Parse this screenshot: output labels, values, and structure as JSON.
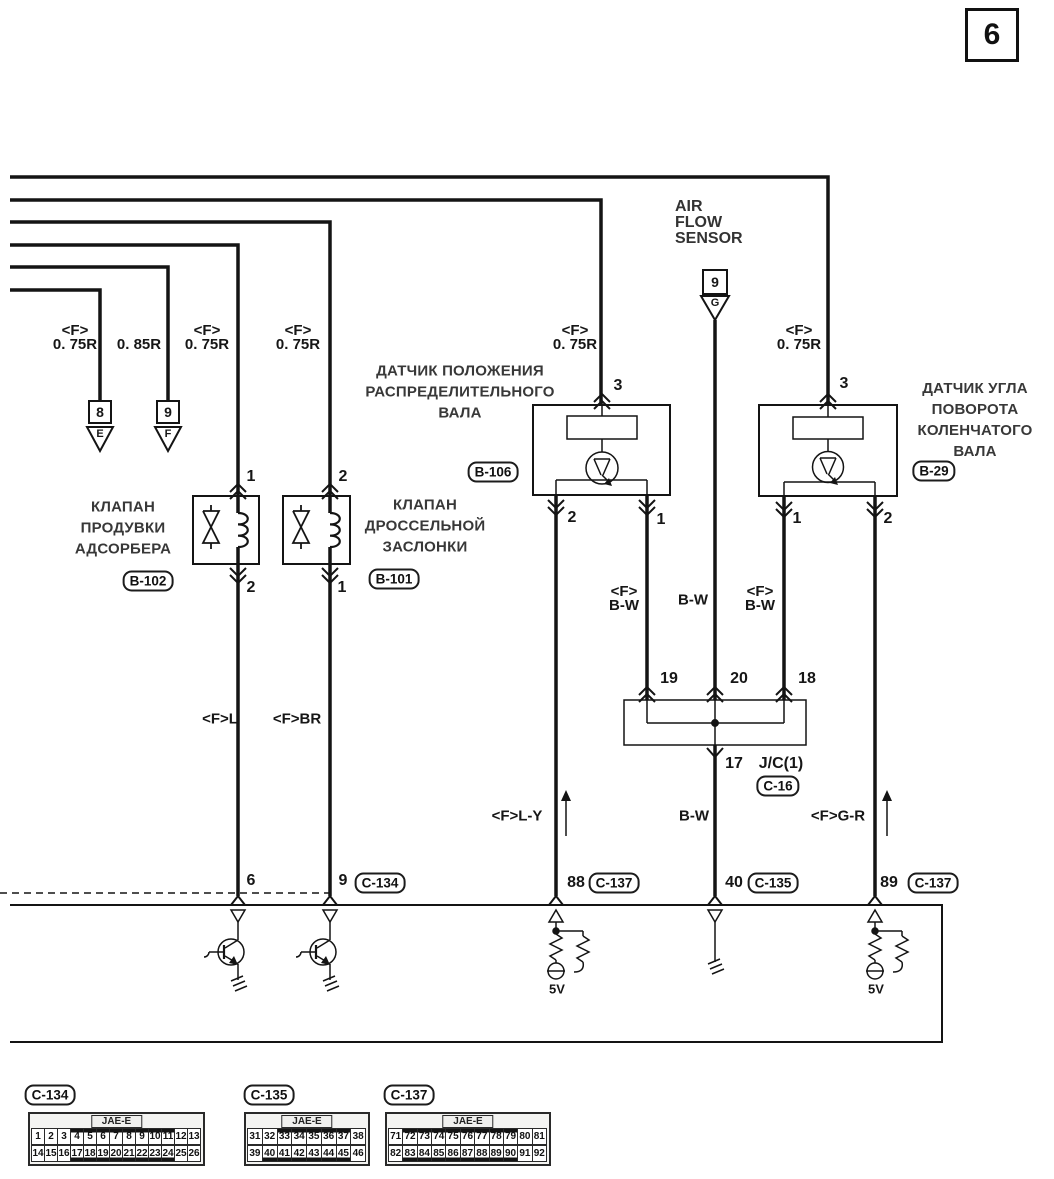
{
  "page_number": "6",
  "air_flow_sensor": [
    "AIR",
    "FLOW",
    "SENSOR"
  ],
  "size_labels": [
    {
      "f": "<F>",
      "size": "0. 75R"
    },
    {
      "f": "",
      "size": "0. 85R"
    },
    {
      "f": "<F>",
      "size": "0. 75R"
    },
    {
      "f": "<F>",
      "size": "0. 75R"
    },
    {
      "f": "<F>",
      "size": "0. 75R"
    },
    {
      "f": "<F>",
      "size": "0. 75R"
    }
  ],
  "offpage_refs": {
    "e8": {
      "num": "8",
      "letter": "E"
    },
    "f9": {
      "num": "9",
      "letter": "F"
    },
    "afs": {
      "num": "9",
      "letter": "G"
    }
  },
  "components": {
    "b102": {
      "lines": [
        "КЛАПАН",
        "ПРОДУВКИ",
        "АДСОРБЕРА"
      ],
      "tag": "B-102",
      "pin_top": "1",
      "pin_bottom": "2"
    },
    "b101": {
      "lines": [
        "КЛАПАН",
        "ДРОССЕЛЬНОЙ",
        "ЗАСЛОНКИ"
      ],
      "tag": "B-101",
      "pin_top": "2",
      "pin_bottom": "1"
    },
    "b106": {
      "lines": [
        "ДАТЧИК ПОЛОЖЕНИЯ",
        "РАСПРЕДЕЛИТЕЛЬНОГО",
        "ВАЛА"
      ],
      "tag": "B-106",
      "pin_top": "3",
      "pin_left": "2",
      "pin_right": "1"
    },
    "b29": {
      "lines": [
        "ДАТЧИК УГЛА",
        "ПОВОРОТА",
        "КОЛЕНЧАТОГО",
        "ВАЛА"
      ],
      "tag": "B-29",
      "pin_top": "3",
      "pin_left": "1",
      "pin_right": "2"
    }
  },
  "junction": {
    "label": "J/C(1)",
    "tag": "C-16",
    "pin19": "19",
    "pin20": "20",
    "pin18": "18",
    "pin17": "17"
  },
  "wire_colors": {
    "fl": "<F>L",
    "fbr": "<F>BR",
    "fbw_l_f": "<F>",
    "fbw_l": "B-W",
    "bw_mid": "B-W",
    "fbw_r_f": "<F>",
    "fbw_r": "B-W",
    "fly": "<F>L-Y",
    "bw_low": "B-W",
    "fgr": "<F>G-R"
  },
  "ecu": {
    "pin6": "6",
    "pin9": "9",
    "tag9": "C-134",
    "pin88": "88",
    "tag88": "C-137",
    "pin40": "40",
    "tag40": "C-135",
    "pin89": "89",
    "tag89": "C-137",
    "v5a": "5V",
    "v5b": "5V"
  },
  "connectors": [
    {
      "tag": "C-134",
      "header": "JAE-E",
      "row1": [
        "1",
        "2",
        "3",
        "4",
        "5",
        "6",
        "7",
        "8",
        "9",
        "10",
        "11",
        "12",
        "13"
      ],
      "row2": [
        "14",
        "15",
        "16",
        "17",
        "18",
        "19",
        "20",
        "21",
        "22",
        "23",
        "24",
        "25",
        "26"
      ],
      "hl1": [
        4,
        11
      ],
      "hl2": [
        17,
        24
      ]
    },
    {
      "tag": "C-135",
      "header": "JAE-E",
      "row1": [
        "31",
        "32",
        "33",
        "34",
        "35",
        "36",
        "37",
        "38"
      ],
      "row2": [
        "39",
        "40",
        "41",
        "42",
        "43",
        "44",
        "45",
        "46"
      ],
      "hl1": [
        33,
        37
      ],
      "hl2": [
        40,
        45
      ]
    },
    {
      "tag": "C-137",
      "header": "JAE-E",
      "row1": [
        "71",
        "72",
        "73",
        "74",
        "75",
        "76",
        "77",
        "78",
        "79",
        "80",
        "81"
      ],
      "row2": [
        "82",
        "83",
        "84",
        "85",
        "86",
        "87",
        "88",
        "89",
        "90",
        "91",
        "92"
      ],
      "hl1": [
        72,
        79
      ],
      "hl2": [
        83,
        90
      ]
    }
  ]
}
